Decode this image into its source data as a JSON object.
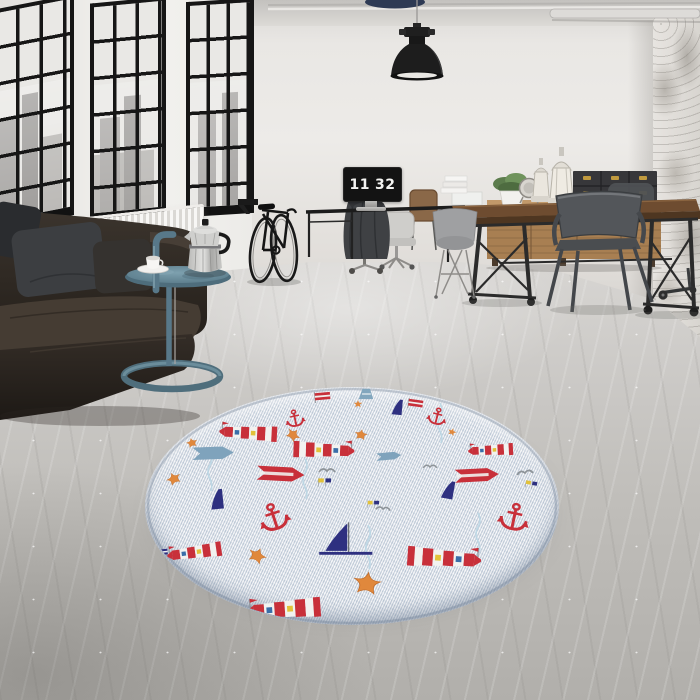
{
  "title": "Industrial loft interior with round nautical rug",
  "clock": {
    "hours": "11",
    "minutes": "32"
  },
  "palette": {
    "wall": "#eceae7",
    "right_wall_distressed": "#d8d5d0",
    "floor": "#c2c0bd",
    "window_frame": "#161616",
    "sofa_leather": "#332c25",
    "pillow_charcoal": "#3c3e41",
    "side_table_teal": "#5d7f8e",
    "moka_silver": "#c9c9c7",
    "radiator_white": "#f4f3f1",
    "wood_sideboard": "#a87f52",
    "table_wood": "#6e4c30",
    "box_black": "#37373a",
    "box_brass": "#c09a3e",
    "lamp_black": "#1d1d1d",
    "chair_gunmetal": "#53565a",
    "rug_base": "#e5e9ee",
    "rug_red": "#c8303a",
    "rug_navy": "#2e3080",
    "rug_orange": "#e0883c",
    "rug_steel_blue": "#7fa3bc",
    "rug_yellow": "#e2c23a",
    "rug_gray": "#8e9499"
  },
  "rug": {
    "shape": "round",
    "style": "nautical",
    "motif_kinds": [
      "lighthouse",
      "anchor",
      "starfish",
      "sailboat",
      "sail",
      "arrow-flag",
      "pennant",
      "seagull",
      "signal-flags",
      "navy-flag",
      "small-star",
      "water-streak"
    ],
    "motifs": [
      {
        "t": "streak",
        "x": 65,
        "y": 84,
        "s": 1,
        "r": 0
      },
      {
        "t": "streak",
        "x": 160,
        "y": 92,
        "s": 1,
        "r": 0
      },
      {
        "t": "streak",
        "x": 295,
        "y": 36,
        "s": 1,
        "r": 0
      },
      {
        "t": "streak",
        "x": 223,
        "y": 160,
        "s": 1.1,
        "r": 0
      },
      {
        "t": "streak",
        "x": 333,
        "y": 146,
        "s": 1,
        "r": 0
      },
      {
        "t": "pennant",
        "x": 178,
        "y": 10,
        "s": 0.9,
        "r": -5
      },
      {
        "t": "bluesail",
        "x": 221,
        "y": 7,
        "s": 0.8,
        "r": 0
      },
      {
        "t": "sail",
        "x": 254,
        "y": 21,
        "s": 0.9,
        "r": 5
      },
      {
        "t": "pennant",
        "x": 271,
        "y": 17,
        "s": 0.85,
        "r": 8
      },
      {
        "t": "anchor",
        "x": 150,
        "y": 32,
        "s": 0.85,
        "r": -12
      },
      {
        "t": "anchor",
        "x": 292,
        "y": 30,
        "s": 0.85,
        "r": 14
      },
      {
        "t": "smallstar",
        "x": 213,
        "y": 17,
        "s": 1,
        "r": 0
      },
      {
        "t": "smallstar",
        "x": 307,
        "y": 45,
        "s": 1,
        "r": 20
      },
      {
        "t": "star",
        "x": 47,
        "y": 56,
        "s": 0.62,
        "r": -15
      },
      {
        "t": "lh",
        "x": 105,
        "y": 46,
        "s": 0.9,
        "r": 3
      },
      {
        "t": "lh",
        "x": 177,
        "y": 63,
        "s": 0.95,
        "r": 2,
        "f": -1
      },
      {
        "t": "lh",
        "x": 347,
        "y": 63,
        "s": 0.7,
        "r": -3
      },
      {
        "t": "arrowblue",
        "x": 70,
        "y": 66,
        "s": 1.25,
        "r": -2
      },
      {
        "t": "arrowblue",
        "x": 245,
        "y": 69,
        "s": 0.75,
        "r": -5
      },
      {
        "t": "star",
        "x": 148,
        "y": 48,
        "s": 0.8,
        "r": 40
      },
      {
        "t": "star",
        "x": 216,
        "y": 48,
        "s": 0.7,
        "r": 10
      },
      {
        "t": "flags",
        "x": 177,
        "y": 95,
        "s": 0.9,
        "r": 0
      },
      {
        "t": "gull",
        "x": 182,
        "y": 84,
        "s": 1,
        "r": 0
      },
      {
        "t": "gull",
        "x": 380,
        "y": 86,
        "s": 1,
        "r": -8
      },
      {
        "t": "gull",
        "x": 285,
        "y": 80,
        "s": 0.85,
        "r": 0
      },
      {
        "t": "flags",
        "x": 384,
        "y": 97,
        "s": 0.8,
        "r": 10
      },
      {
        "t": "arrowred",
        "x": 138,
        "y": 87,
        "s": 1.3,
        "r": 3
      },
      {
        "t": "arrowred",
        "x": 334,
        "y": 88,
        "s": 1.2,
        "r": -3
      },
      {
        "t": "star",
        "x": 29,
        "y": 92,
        "s": 0.8,
        "r": -25
      },
      {
        "t": "sail",
        "x": 74,
        "y": 113,
        "s": 1.15,
        "r": -6
      },
      {
        "t": "sail",
        "x": 305,
        "y": 104,
        "s": 1.05,
        "r": 10
      },
      {
        "t": "navyflag",
        "x": 17,
        "y": 165,
        "s": 0.8,
        "r": -5
      },
      {
        "t": "anchor",
        "x": 129,
        "y": 131,
        "s": 1.35,
        "r": -18
      },
      {
        "t": "anchor",
        "x": 369,
        "y": 131,
        "s": 1.35,
        "r": 12
      },
      {
        "t": "gull",
        "x": 238,
        "y": 122,
        "s": 0.9,
        "r": 5
      },
      {
        "t": "flags",
        "x": 226,
        "y": 117,
        "s": 0.8,
        "r": 0
      },
      {
        "t": "boat",
        "x": 198,
        "y": 152,
        "s": 1.4,
        "r": 0
      },
      {
        "t": "lh",
        "x": 51,
        "y": 165,
        "s": 0.85,
        "r": -8
      },
      {
        "t": "lh",
        "x": 297,
        "y": 171,
        "s": 1.15,
        "r": 4,
        "f": -1
      },
      {
        "t": "star",
        "x": 112,
        "y": 169,
        "s": 1.0,
        "r": 25
      },
      {
        "t": "star",
        "x": 222,
        "y": 197,
        "s": 1.5,
        "r": 8
      },
      {
        "t": "lh",
        "x": 141,
        "y": 222,
        "s": 1.15,
        "r": -4
      },
      {
        "t": "pennant",
        "x": 48,
        "y": 214,
        "s": 0.9,
        "r": 10
      }
    ]
  }
}
